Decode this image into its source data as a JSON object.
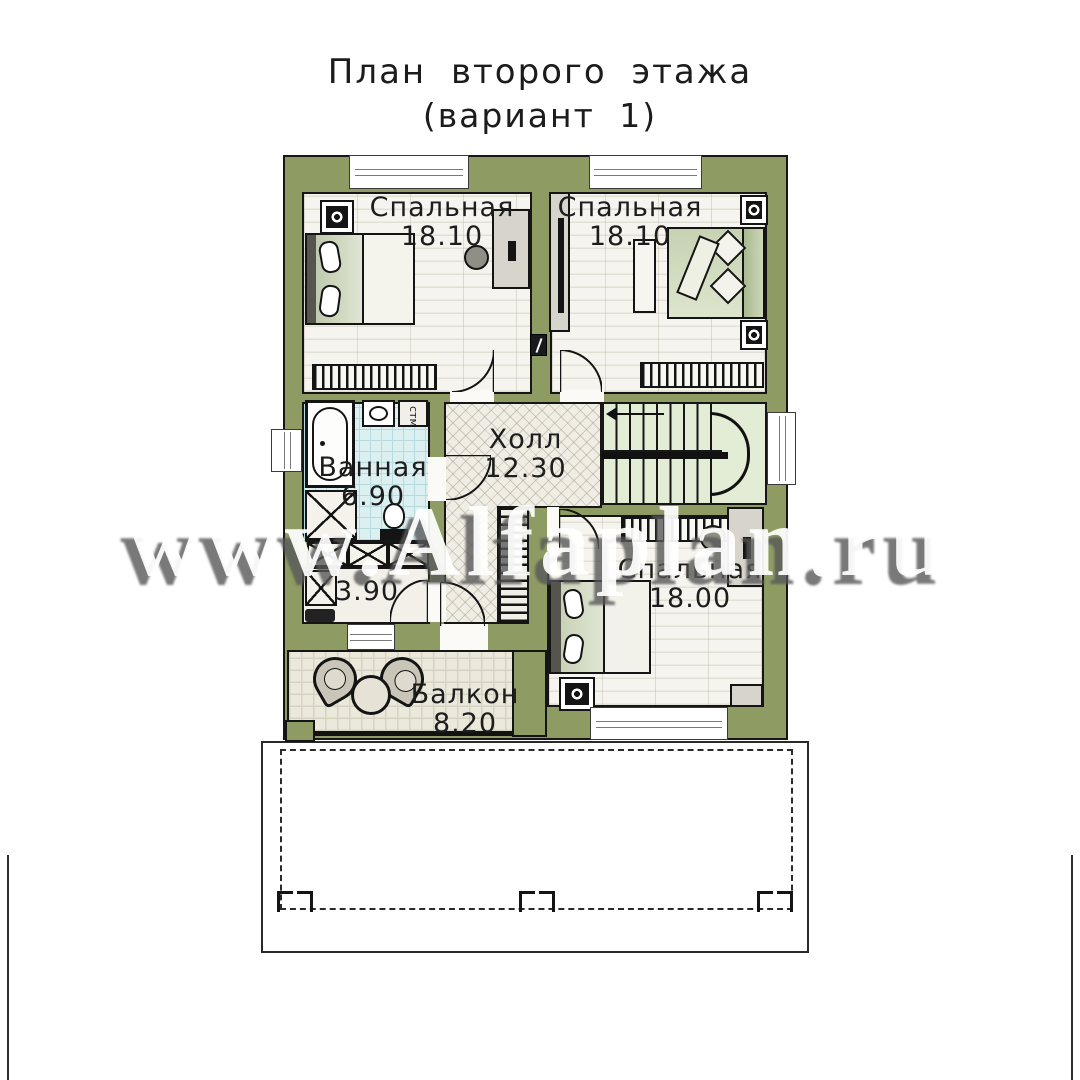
{
  "title": {
    "line1": "План второго этажа",
    "line2": "(вариант 1)"
  },
  "watermark_text": "www.Alfaplan.ru",
  "rooms": {
    "bedroom_top_left": {
      "name": "Спальная",
      "area": "18.10"
    },
    "bedroom_top_right": {
      "name": "Спальная",
      "area": "18.10"
    },
    "hall": {
      "name": "Холл",
      "area": "12.30"
    },
    "bathroom": {
      "name": "Ванная",
      "area": "6.90"
    },
    "storage": {
      "area": "3.90"
    },
    "bedroom_bottom": {
      "name": "Спальная",
      "area": "18.00"
    },
    "balcony": {
      "name": "Балкон",
      "area": "8.20"
    }
  },
  "fixtures": {
    "washing_machine_label": "стм"
  },
  "colors": {
    "wall": "#8e9c63",
    "stair-floor": "#e3ecd4",
    "bath-tile": "#dcf0f1",
    "hall-floor": "#f0ede4",
    "plank-floor": "#f6f4ee",
    "balcony-floor": "#ebe8dc",
    "line": "#161616"
  }
}
